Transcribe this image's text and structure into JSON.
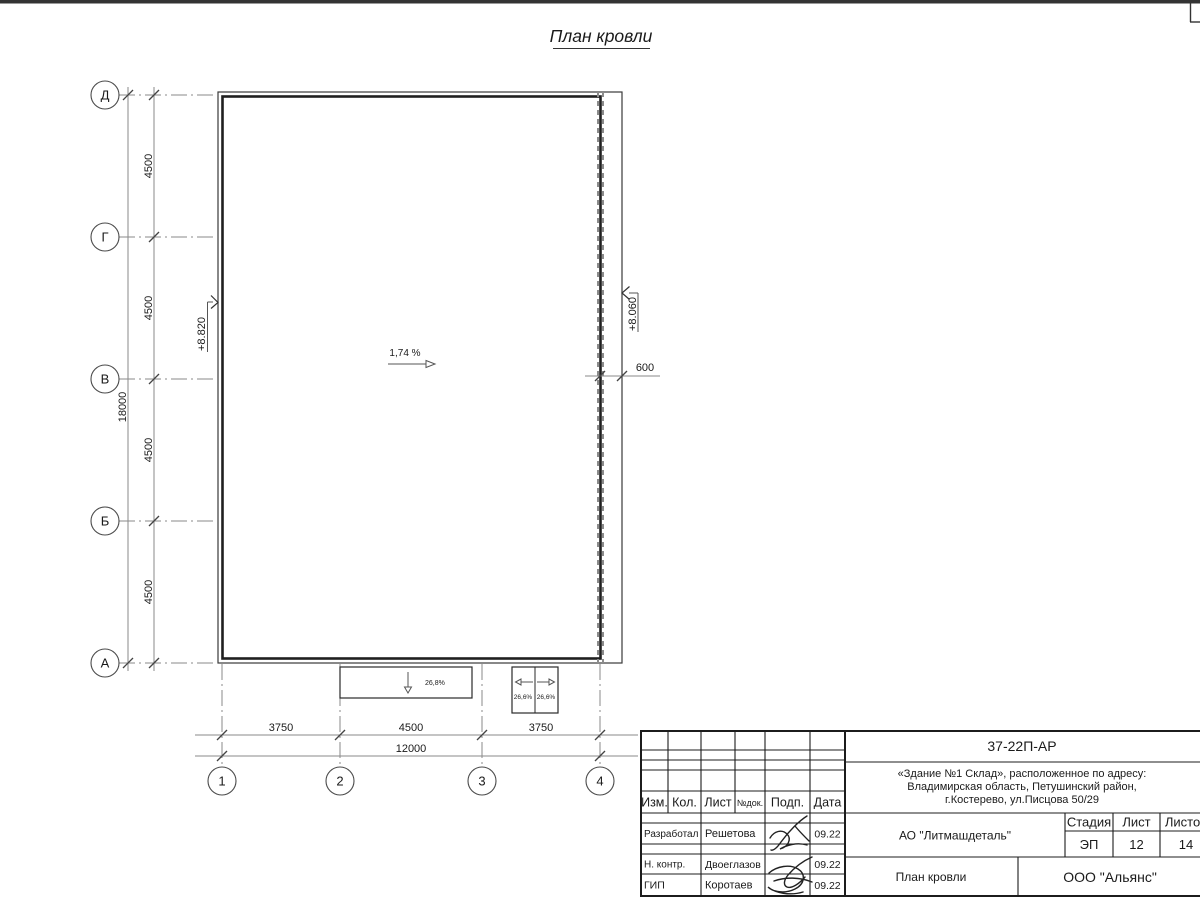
{
  "page": {
    "title": "План кровли"
  },
  "plan": {
    "slope_label": "1,74 %",
    "elev_left": "+8.820",
    "elev_right": "+8.060",
    "dim_600": "600",
    "canopy_front_slope": "26,8%",
    "canopy_side_slope_left": "26,6%",
    "canopy_side_slope_right": "26,6%",
    "row_axes": [
      "Д",
      "Г",
      "В",
      "Б",
      "А"
    ],
    "col_axes": [
      "1",
      "2",
      "3",
      "4"
    ],
    "row_dims": [
      "4500",
      "4500",
      "4500",
      "4500"
    ],
    "row_total": "18000",
    "col_dims": [
      "3750",
      "4500",
      "3750"
    ],
    "col_total": "12000"
  },
  "titleblock": {
    "doc_number": "37-22П-АР",
    "object_address_lines": [
      "«Здание №1 Склад», расположенное по адресу:",
      "Владимирская область, Петушинский район,",
      "г.Костерево, ул.Писцова 50/29"
    ],
    "client": "АО \"Литмашдеталь\"",
    "sheet_name": "План кровли",
    "company": "ООО \"Альянс\"",
    "col_headers": {
      "izm": "Изм.",
      "kol": "Кол.",
      "list": "Лист",
      "doc": "№док.",
      "sign": "Подп.",
      "date": "Дата"
    },
    "stage_header": "Стадия",
    "sheet_header": "Лист",
    "sheets_header": "Листов",
    "stage": "ЭП",
    "sheet": "12",
    "sheets": "14",
    "rows": [
      {
        "role": "Разработал",
        "name": "Решетова",
        "date": "09.22"
      },
      {
        "role": "Н. контр.",
        "name": "Двоеглазов",
        "date": "09.22"
      },
      {
        "role": "ГИП",
        "name": "Коротаев",
        "date": "09.22"
      }
    ]
  }
}
